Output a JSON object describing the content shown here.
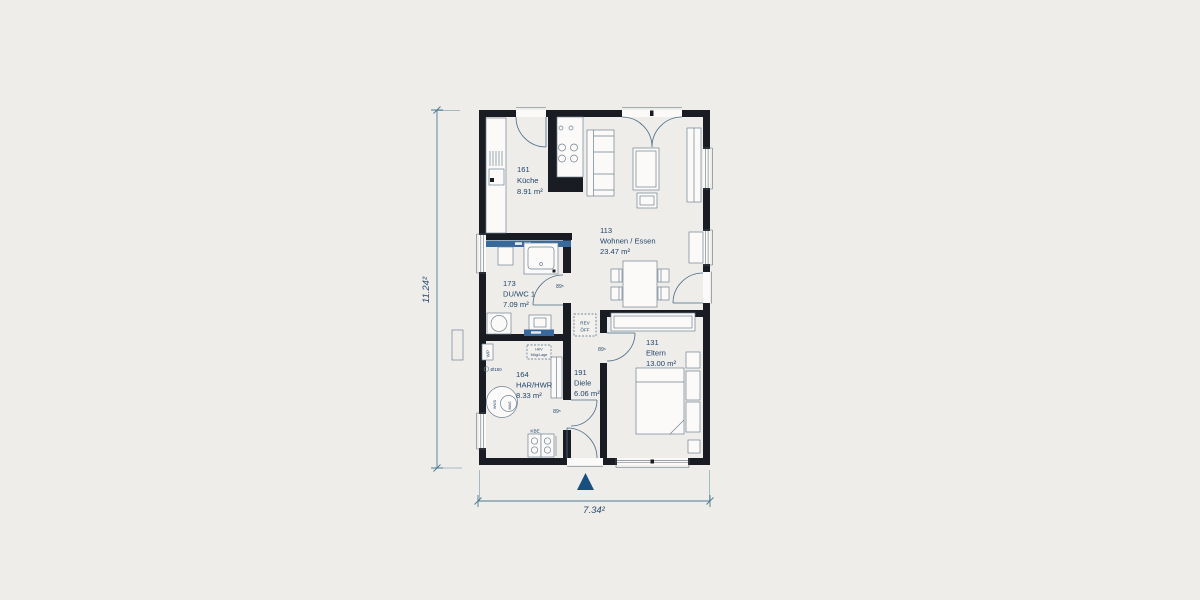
{
  "rooms": [
    {
      "number": "161",
      "name": "Küche",
      "area": "8.91 m²"
    },
    {
      "number": "113",
      "name": "Wohnen / Essen",
      "area": "23.47 m²"
    },
    {
      "number": "173",
      "name": "DU/WC 1",
      "area": "7.09 m²"
    },
    {
      "number": "164",
      "name": "HAR/HWR",
      "area": "8.33 m²"
    },
    {
      "number": "191",
      "name": "Diele",
      "area": "6.06 m²"
    },
    {
      "number": "131",
      "name": "Eltern",
      "area": "13.00 m²"
    }
  ],
  "dimensions": {
    "height": "11.24²",
    "width": "7.34²"
  },
  "door_width_label": "89⁵",
  "annotations": {
    "wp": "WP",
    "duct": "Ø150",
    "hkv_line1": "HKV",
    "hkv_line2": "Mögl.Lage",
    "rev_line1": "REV",
    "rev_line2": "ÖFF",
    "kbe": "KBE",
    "wws": "WWS",
    "mag": "MAG"
  },
  "colors": {
    "background": "#efedea",
    "wall": "#1a1c23",
    "text": "#21456a",
    "fixture_blue": "#39689a",
    "dimension": "#4b7a92",
    "arrow": "#155081"
  }
}
